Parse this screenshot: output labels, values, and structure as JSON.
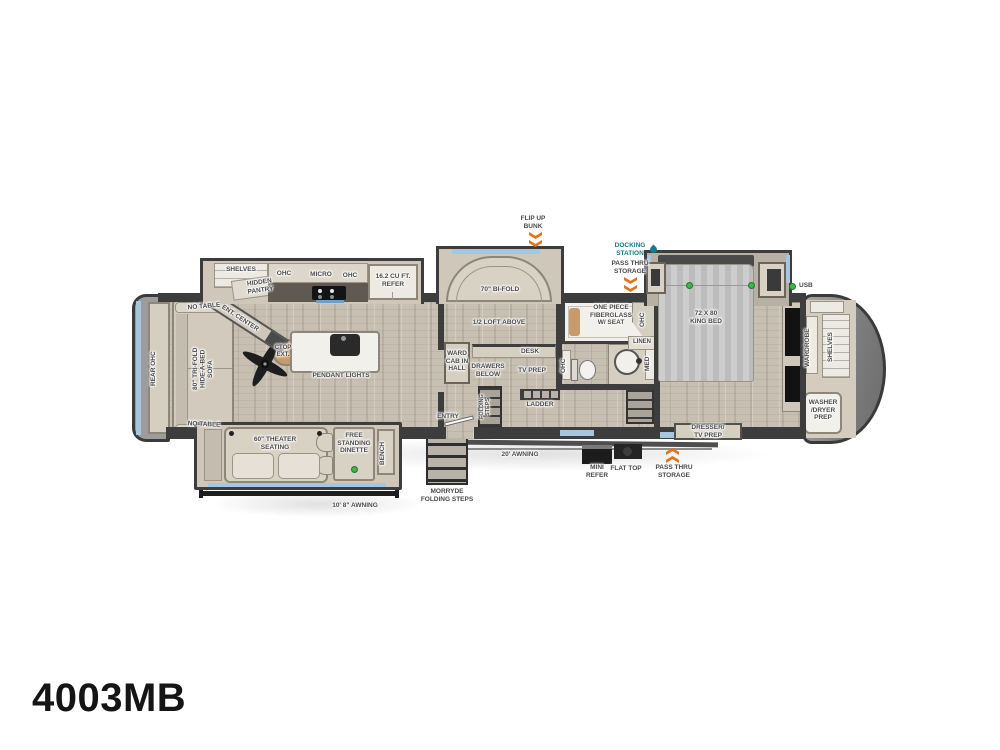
{
  "model": "4003MB",
  "colors": {
    "wall": "#3d3d3d",
    "accent_blue": "#a5c6dd",
    "arrow_orange": "#e4731c",
    "docking_teal": "#157c8c",
    "usb_green": "#45b14e"
  },
  "icons": {
    "docking_station": "droplet-icon",
    "pass_thru_storage": "double-chevron-arrow-icon",
    "usb": "green-dot-icon",
    "ceiling_fan": "fan-icon"
  },
  "labels": {
    "flip_up_bunk": "FLIP UP\nBUNK",
    "docking_station": "DOCKING\nSTATION",
    "pass_thru_top": "PASS THRU\nSTORAGE",
    "usb": "USB",
    "shelves_kitchen": "SHELVES",
    "hidden_pantry": "HIDDEN\nPANTRY",
    "ohc_kitchen_left": "OHC",
    "micro": "MICRO",
    "ohc_kitchen_right": "OHC",
    "refer": "16.2 CU FT.\nREFER",
    "ent_center": "ENT. CENTER",
    "no_table_top": "NO TABLE",
    "no_table_bottom": "NO TABLE",
    "rear_ohc": "REAR OHC",
    "sofa": "80\" TRI-FOLD\nHIDE-A-BED\nSOFA",
    "ctop_ext": "CTOP\nEXT.",
    "pendant_lights": "PENDANT LIGHTS",
    "bi_fold": "70\" BI-FOLD",
    "half_loft": "1/2 LOFT ABOVE",
    "ward_cab": "WARD\nCAB IN\nHALL",
    "drawers_below": "DRAWERS\nBELOW",
    "desk": "DESK",
    "tv_prep": "TV PREP",
    "ladder": "LADDER",
    "entry": "ENTRY",
    "folding_steps": "FOLDING\nSTEPS",
    "shower": "ONE PIECE\nFIBERGLASS\nW/ SEAT",
    "ohc_bath_toilet": "OHC",
    "ohc_bath_corner": "OHC",
    "linen": "LINEN",
    "med": "MED",
    "king_bed": "72 X 80\nKING BED",
    "dresser_tv": "DRESSER/\nTV PREP",
    "wardrobe_front": "WARDROBE",
    "shelves_front": "SHELVES",
    "washer_dryer": "WASHER\n/DRYER\nPREP",
    "theater_seating": "60\" THEATER\nSEATING",
    "dinette": "FREE\nSTANDING\nDINETTE",
    "bench": "BENCH",
    "awning_slide": "10' 8\" AWNING",
    "awning_main": "20' AWNING",
    "morryde_steps": "MORRYDE\nFOLDING STEPS",
    "mini_refer": "MINI\nREFER",
    "flat_top": "FLAT TOP",
    "pass_thru_bottom": "PASS THRU\nSTORAGE"
  }
}
